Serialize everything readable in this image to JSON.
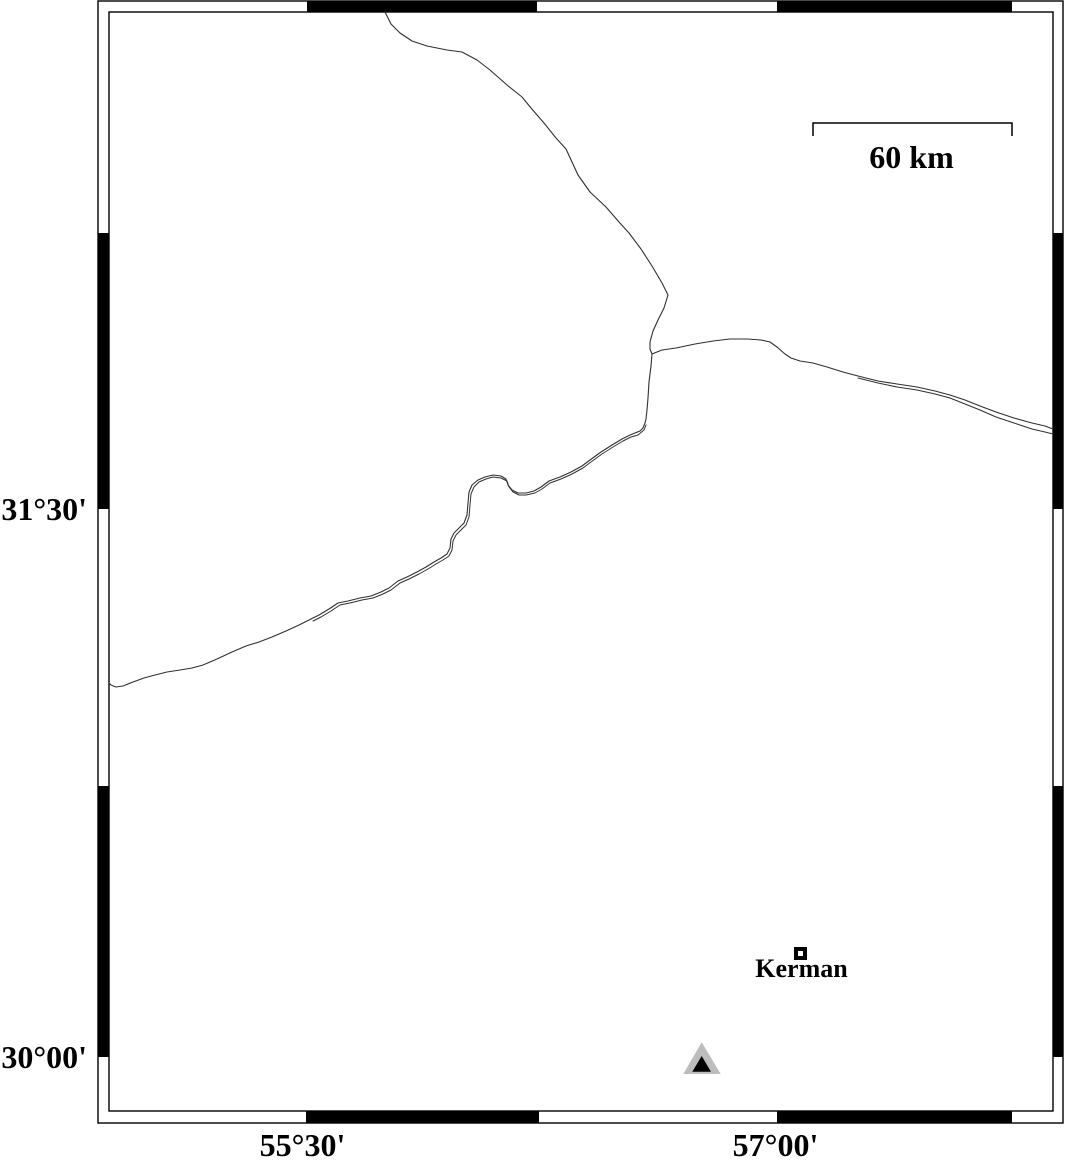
{
  "colors": {
    "background": "#ffffff",
    "frame_stroke": "#000000",
    "band_black": "#000000",
    "line": "#303030",
    "station_outer_fill": "#bdbdbd",
    "station_inner_fill": "#000000",
    "city_fill": "#000000",
    "city_center": "#ffffff",
    "text": "#000000"
  },
  "frame": {
    "outer": [
      98,
      1,
      965,
      1122
    ],
    "inner": [
      109,
      12,
      944,
      1099
    ],
    "stroke_width": 1.4,
    "band": {
      "top_black": [
        [
          307,
          537
        ],
        [
          777,
          1012
        ]
      ],
      "bottom_black": [
        [
          306,
          539
        ],
        [
          777,
          1012
        ]
      ],
      "left_black": [
        [
          233,
          509
        ],
        [
          786,
          1057
        ]
      ],
      "right_black": [
        [
          233,
          509
        ],
        [
          786,
          1057
        ]
      ]
    }
  },
  "axis_labels": {
    "lat": [
      {
        "text": "31°30'"
      },
      {
        "text": "30°00'"
      }
    ],
    "lon": [
      {
        "text": "55°30'"
      },
      {
        "text": "57°00'"
      }
    ]
  },
  "scale_bar": {
    "label": "60 km",
    "x1": 813,
    "x2": 1012,
    "y": 123,
    "tick_drop": 13,
    "stroke_width": 1.5
  },
  "city": {
    "label": "Kerman",
    "x": 800.5,
    "y": 953.5,
    "size": 13,
    "inner_size": 5
  },
  "station": {
    "outer_points": "701.7,1042.3 683.3,1074 720.7,1074",
    "inner_points": "701.7,1056 692.3,1071.7 711,1071.7"
  },
  "map_lines": [
    {
      "name": "boundary-line-north",
      "width": 1.1,
      "points": [
        [
          385,
          12
        ],
        [
          391,
          24
        ],
        [
          400,
          33
        ],
        [
          412,
          41
        ],
        [
          427,
          46
        ],
        [
          447,
          50
        ],
        [
          462,
          52
        ],
        [
          477,
          60
        ],
        [
          490,
          70
        ],
        [
          507,
          85
        ],
        [
          522,
          97
        ],
        [
          531,
          108
        ],
        [
          544,
          123
        ],
        [
          556,
          138
        ],
        [
          566,
          149
        ],
        [
          572,
          162
        ],
        [
          578,
          175
        ],
        [
          590,
          192
        ],
        [
          606,
          207
        ],
        [
          619,
          222
        ],
        [
          629,
          233
        ],
        [
          641,
          249
        ],
        [
          652,
          266
        ],
        [
          662,
          283
        ],
        [
          668,
          295
        ],
        [
          664,
          308
        ],
        [
          658,
          320
        ],
        [
          653,
          331
        ],
        [
          650,
          342
        ],
        [
          650,
          349
        ],
        [
          652,
          354
        ]
      ]
    },
    {
      "name": "boundary-line-east-a",
      "width": 1.1,
      "points": [
        [
          652,
          354
        ],
        [
          662,
          350
        ],
        [
          676,
          348
        ],
        [
          695,
          344
        ],
        [
          713,
          341
        ],
        [
          730,
          339
        ],
        [
          747,
          339
        ],
        [
          761,
          340
        ],
        [
          770,
          342
        ],
        [
          777,
          347
        ],
        [
          785,
          354
        ],
        [
          791,
          358
        ],
        [
          800,
          361
        ],
        [
          813,
          363
        ],
        [
          827,
          367
        ],
        [
          843,
          372
        ],
        [
          858,
          376
        ],
        [
          878,
          381
        ],
        [
          897,
          384
        ],
        [
          917,
          387
        ],
        [
          935,
          391
        ],
        [
          950,
          395
        ],
        [
          965,
          400
        ],
        [
          980,
          406
        ],
        [
          996,
          412
        ],
        [
          1014,
          418
        ],
        [
          1032,
          423
        ],
        [
          1045,
          426
        ],
        [
          1053,
          429
        ]
      ]
    },
    {
      "name": "boundary-line-east-b",
      "width": 1,
      "points": [
        [
          858,
          378
        ],
        [
          878,
          383
        ],
        [
          897,
          387
        ],
        [
          917,
          390
        ],
        [
          935,
          394
        ],
        [
          950,
          398
        ],
        [
          965,
          404
        ],
        [
          980,
          410
        ],
        [
          996,
          417
        ],
        [
          1014,
          423
        ],
        [
          1032,
          429
        ],
        [
          1045,
          432
        ],
        [
          1053,
          434
        ]
      ]
    },
    {
      "name": "boundary-line-southwest-a",
      "width": 1.1,
      "points": [
        [
          652,
          354
        ],
        [
          651,
          366
        ],
        [
          649,
          382
        ],
        [
          648,
          398
        ],
        [
          647,
          410
        ],
        [
          646,
          419
        ],
        [
          645,
          423
        ],
        [
          643,
          428
        ],
        [
          640,
          431
        ],
        [
          635,
          433
        ],
        [
          630,
          435
        ],
        [
          622,
          439
        ],
        [
          612,
          445
        ],
        [
          601,
          452
        ],
        [
          590,
          460
        ],
        [
          582,
          466
        ],
        [
          571,
          472
        ],
        [
          560,
          477
        ],
        [
          549,
          481
        ],
        [
          541,
          487
        ],
        [
          534,
          491
        ],
        [
          526,
          493
        ],
        [
          518,
          493
        ],
        [
          512,
          490
        ],
        [
          508,
          485
        ],
        [
          506,
          479
        ],
        [
          501,
          476
        ],
        [
          493,
          475
        ],
        [
          485,
          477
        ],
        [
          478,
          480
        ],
        [
          472,
          485
        ],
        [
          469,
          492
        ],
        [
          468,
          503
        ],
        [
          467,
          515
        ],
        [
          464,
          523
        ],
        [
          459,
          528
        ],
        [
          454,
          533
        ],
        [
          451,
          539
        ],
        [
          450,
          548
        ],
        [
          447,
          554
        ],
        [
          441,
          558
        ],
        [
          434,
          562
        ],
        [
          426,
          567
        ],
        [
          417,
          572
        ],
        [
          407,
          577
        ],
        [
          398,
          581
        ],
        [
          389,
          588
        ],
        [
          381,
          592
        ],
        [
          371,
          596
        ],
        [
          360,
          598
        ],
        [
          348,
          601
        ],
        [
          338,
          603
        ],
        [
          329,
          609
        ],
        [
          319,
          615
        ],
        [
          311,
          619
        ],
        [
          299,
          625
        ],
        [
          286,
          631
        ],
        [
          272,
          637
        ],
        [
          259,
          642
        ],
        [
          246,
          646
        ],
        [
          232,
          652
        ],
        [
          217,
          659
        ],
        [
          203,
          665
        ],
        [
          192,
          668
        ],
        [
          180,
          670
        ],
        [
          167,
          672
        ],
        [
          155,
          675
        ],
        [
          144,
          678
        ],
        [
          133,
          682
        ],
        [
          123,
          686
        ],
        [
          116,
          687
        ],
        [
          111,
          685
        ],
        [
          109,
          683
        ]
      ]
    },
    {
      "name": "boundary-line-southwest-b",
      "width": 1,
      "points": [
        [
          646,
          425
        ],
        [
          644,
          430
        ],
        [
          638,
          435
        ],
        [
          631,
          437
        ],
        [
          623,
          441
        ],
        [
          613,
          447
        ],
        [
          602,
          454
        ],
        [
          591,
          462
        ],
        [
          583,
          468
        ],
        [
          572,
          474
        ],
        [
          561,
          479
        ],
        [
          550,
          483
        ],
        [
          542,
          489
        ],
        [
          535,
          493
        ],
        [
          526,
          495
        ],
        [
          519,
          495
        ],
        [
          513,
          492
        ],
        [
          509,
          487
        ],
        [
          507,
          481
        ],
        [
          501,
          478
        ],
        [
          493,
          477
        ],
        [
          486,
          479
        ],
        [
          479,
          482
        ],
        [
          474,
          487
        ],
        [
          471,
          494
        ],
        [
          470,
          505
        ],
        [
          469,
          517
        ],
        [
          466,
          525
        ],
        [
          461,
          530
        ],
        [
          456,
          535
        ],
        [
          453,
          541
        ],
        [
          452,
          550
        ],
        [
          449,
          556
        ],
        [
          443,
          560
        ],
        [
          436,
          564
        ],
        [
          428,
          569
        ],
        [
          419,
          574
        ],
        [
          409,
          579
        ],
        [
          400,
          583
        ],
        [
          391,
          590
        ],
        [
          383,
          594
        ],
        [
          373,
          598
        ],
        [
          362,
          600
        ],
        [
          350,
          603
        ],
        [
          340,
          605
        ],
        [
          331,
          611
        ],
        [
          321,
          617
        ],
        [
          313,
          621
        ]
      ]
    }
  ]
}
